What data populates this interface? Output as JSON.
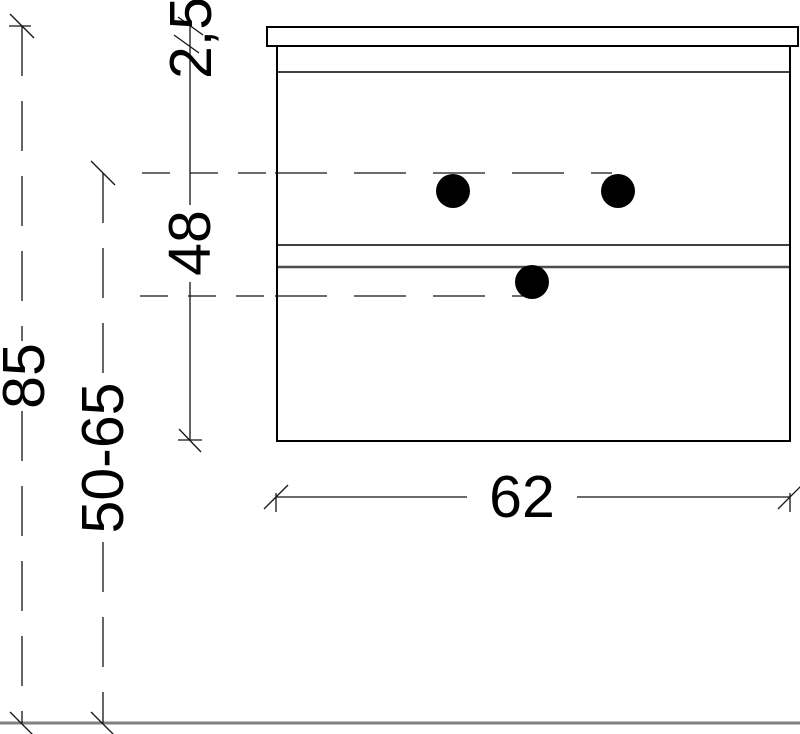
{
  "drawing": {
    "kind": "cad-dimension-drawing",
    "subject": "wall-mounted cabinet with countertop, front elevation",
    "units": "cm",
    "labels": {
      "overall_height": "85",
      "mounting_height_range": "50-65",
      "cabinet_height": "48",
      "countertop_thickness": "2,5",
      "cabinet_width": "62"
    },
    "colors": {
      "background": "#ffffff",
      "outline": "#000000",
      "dimension_line": "#141414",
      "gray_divider": "#4d4d4d",
      "floor_line": "#808080",
      "knob": "#000000"
    }
  }
}
